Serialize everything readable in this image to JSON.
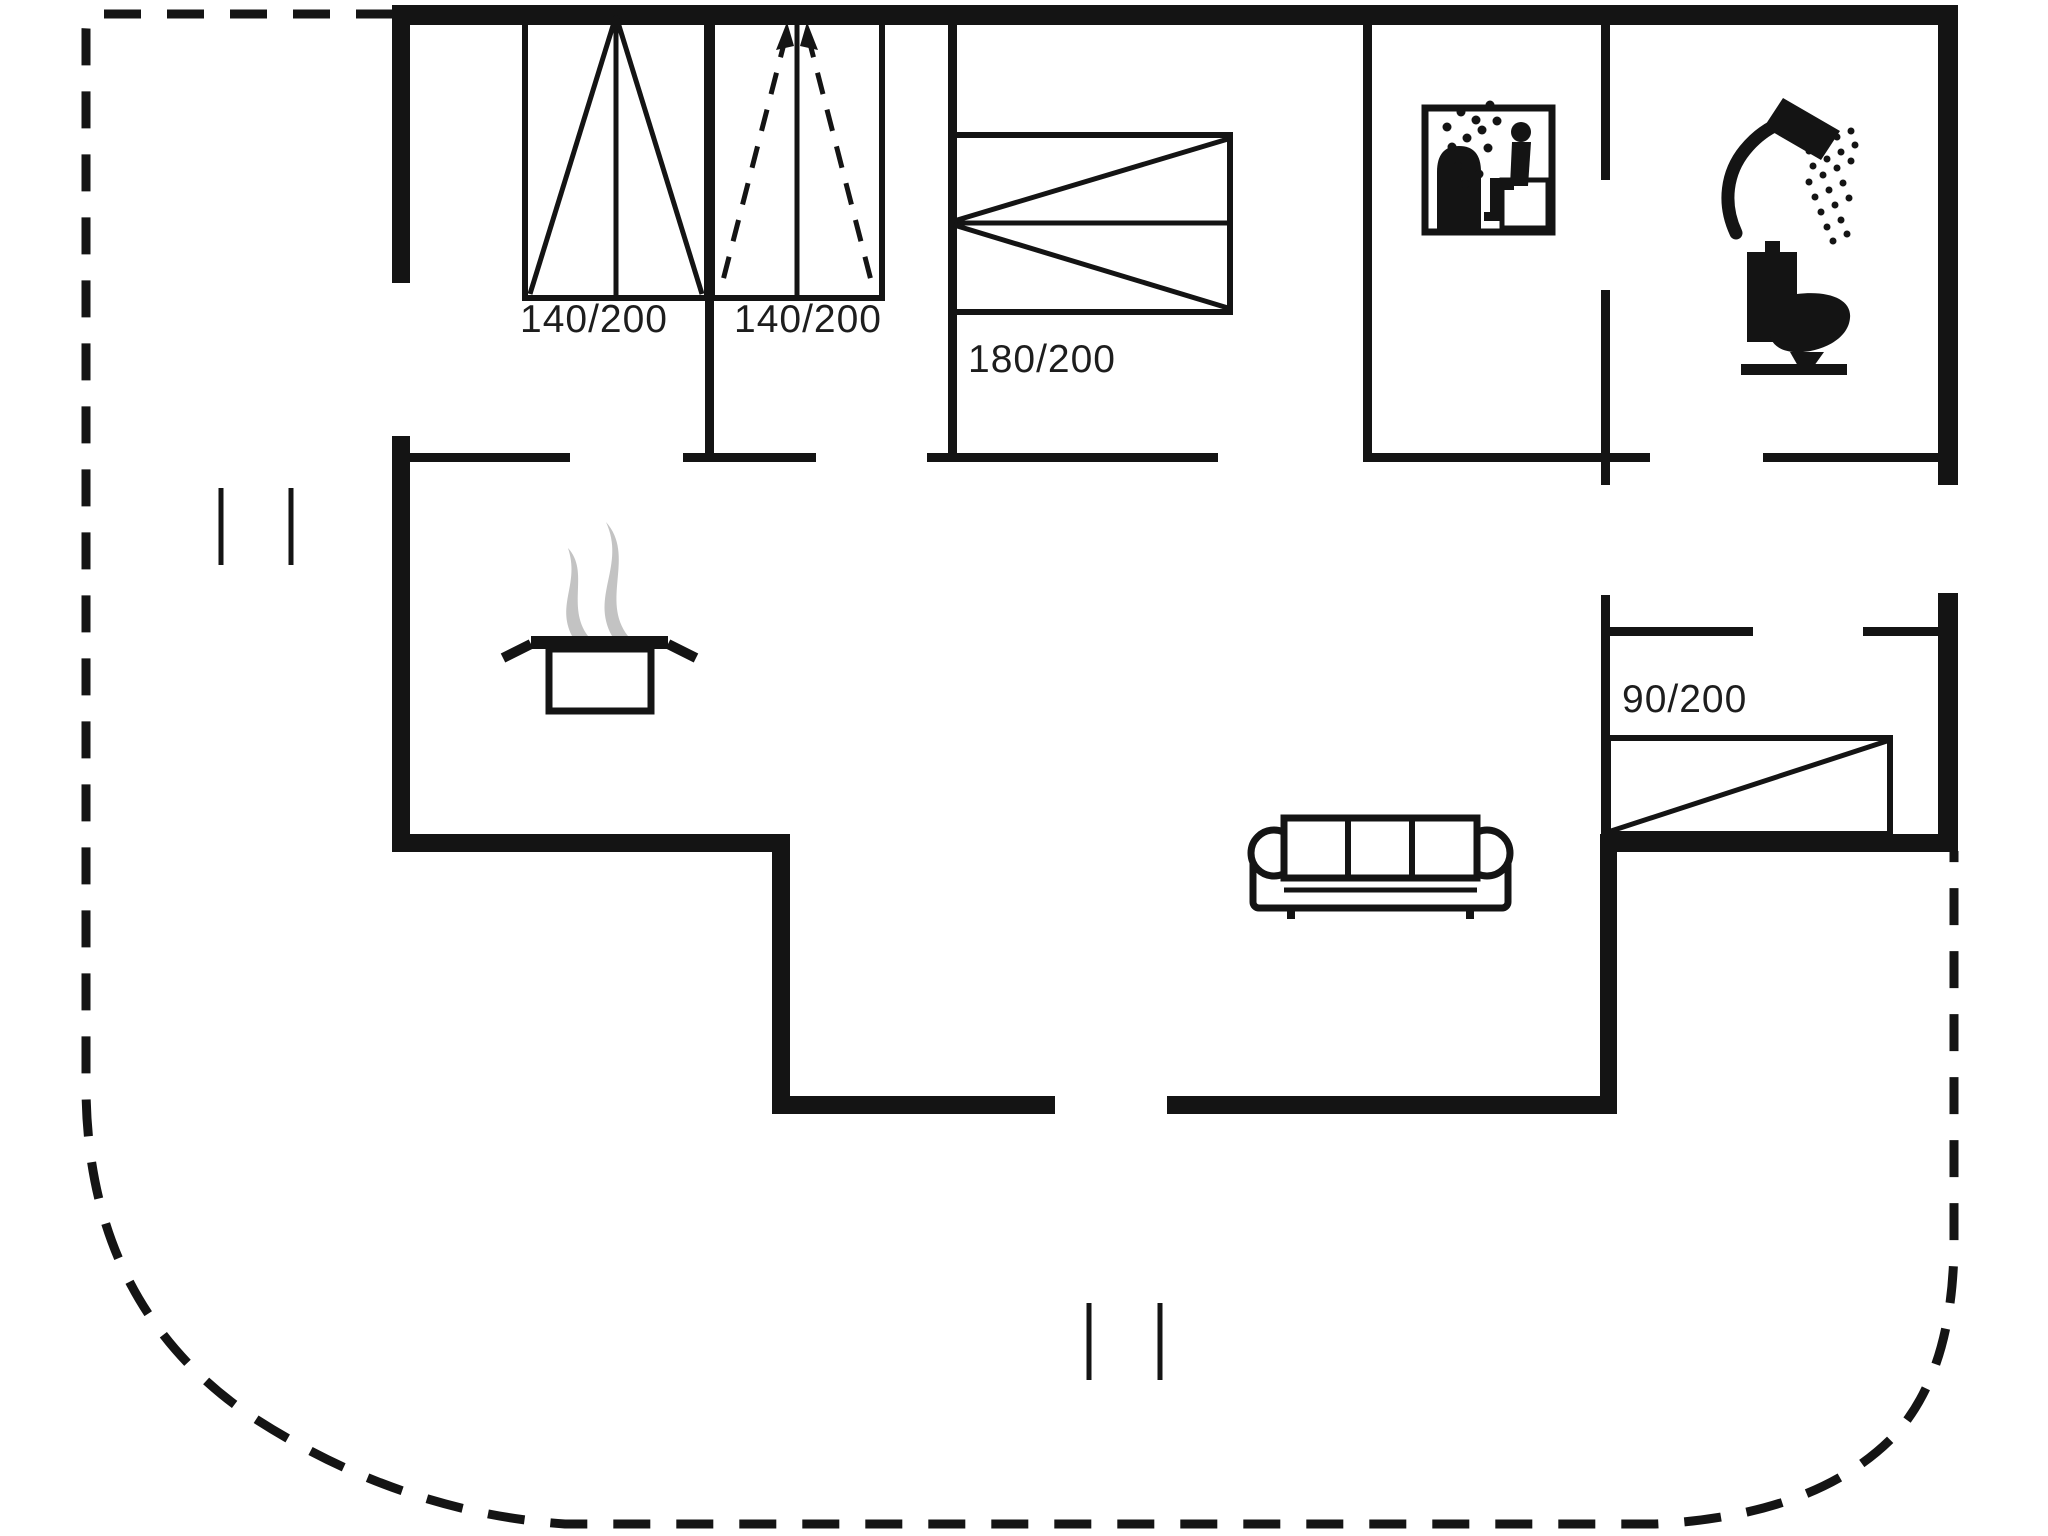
{
  "plan": {
    "title": "Holiday house floor plan",
    "background_color": "#ffffff",
    "wall_color": "#141414",
    "steam_color": "#c3c3c3",
    "beds": [
      {
        "id": "double-bed-1",
        "size_label": "140/200"
      },
      {
        "id": "double-bed-2",
        "size_label": "140/200"
      },
      {
        "id": "double-bed-3",
        "size_label": "180/200"
      },
      {
        "id": "single-bed-4",
        "size_label": "90/200"
      }
    ],
    "fixtures": [
      "sauna-icon",
      "shower-icon",
      "toilet-icon",
      "cooking-pot-icon",
      "sofa"
    ]
  }
}
